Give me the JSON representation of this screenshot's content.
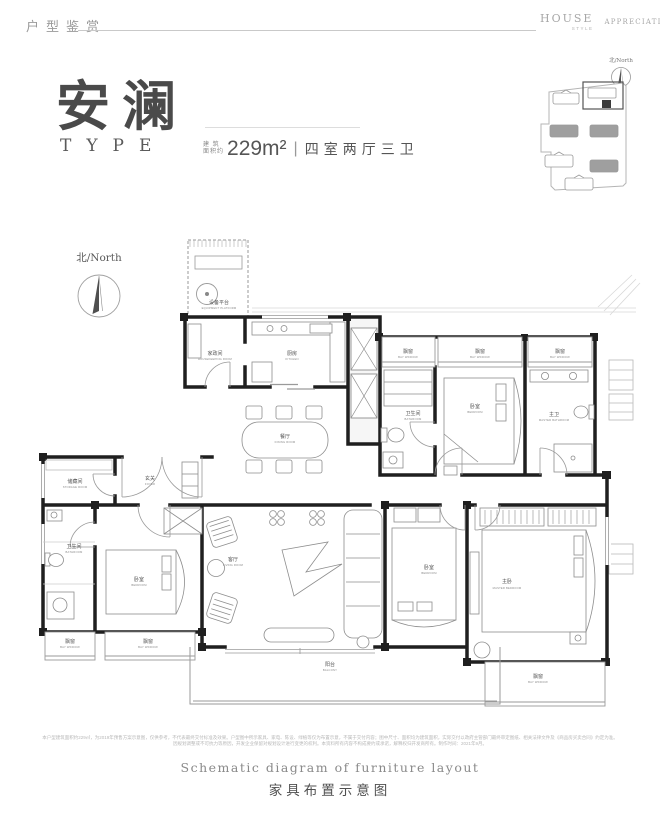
{
  "header": {
    "section_title": "户型鉴赏",
    "brand": {
      "line1": "HOUSE",
      "line2": "STYLE",
      "right": "APPRECIATION"
    }
  },
  "hero": {
    "name": "安澜",
    "type_label": "TYPE",
    "area_prefix_line1": "建 筑",
    "area_prefix_line2": "面积约",
    "area_value": "229m²",
    "divider": "|",
    "spec": "四室两厅三卫"
  },
  "compass": {
    "label": "北/North"
  },
  "keyplan": {
    "north_label": "北/North"
  },
  "plan": {
    "rooms": {
      "equipment": {
        "zh": "设备平台",
        "en": "EQUIPMENT PLATFORM"
      },
      "housekeeping": {
        "zh": "家政间",
        "en": "HOUSEKEEPING ROOM"
      },
      "kitchen": {
        "zh": "厨房",
        "en": "KITCHEN"
      },
      "dining": {
        "zh": "餐厅",
        "en": "DINING ROOM"
      },
      "foyer": {
        "zh": "玄关",
        "en": "FOYER"
      },
      "storage": {
        "zh": "储藏间",
        "en": "STORAGE ROOM"
      },
      "bathroom": {
        "zh": "卫生间",
        "en": "BATHROOM"
      },
      "bedroom": {
        "zh": "卧室",
        "en": "BEDROOM"
      },
      "master_bathroom": {
        "zh": "主卫",
        "en": "MASTER BATHROOM"
      },
      "master_bedroom": {
        "zh": "主卧",
        "en": "MASTER BEDROOM"
      },
      "living": {
        "zh": "客厅",
        "en": "LIVING ROOM"
      },
      "balcony": {
        "zh": "阳台",
        "en": "BALCONY"
      },
      "bay_window": {
        "zh": "飘窗",
        "en": "BAY WINDOW"
      }
    }
  },
  "disclaimer": {
    "line1": "本户型建筑面积约229㎡，为2019年预售方案示意图，仅供参考，不代表最终交付标准及效果。户型图中所示家具、家电、陈设、绿植等仅为布置示意，不属于交付内容；图中尺寸、面积均为建筑面积，实际交付以政府主管部门最终审定图纸、相关法律文件及《商品房买卖合同》约定为准。",
    "line2": "因规划调整或不可抗力等原因，开发企业保留对规划设计进行变更的权利。本资料所有内容不构成要约或承诺，解释权归开发商所有。制作时间：2021年9月。"
  },
  "footer": {
    "caption_en": "Schematic diagram of furniture layout",
    "caption_zh": "家具布置示意图"
  }
}
